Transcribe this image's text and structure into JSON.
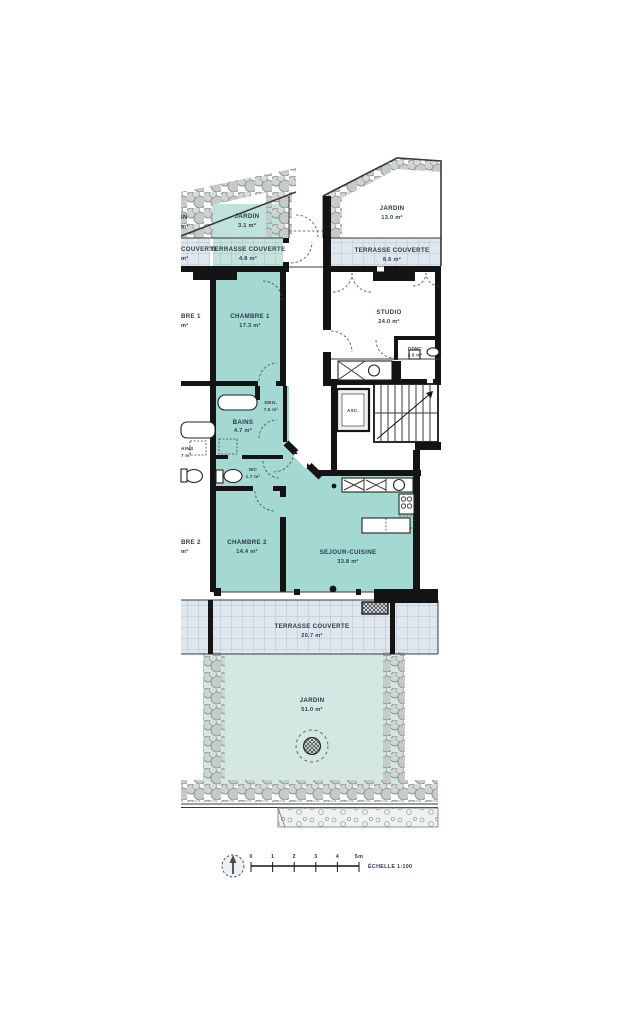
{
  "document": {
    "type": "floor-plan",
    "scale_note": "ÉCHELLE 1:100"
  },
  "colors": {
    "room_teal": "#a3d9d2",
    "jardin_small_teal": "#bfe2db",
    "jardin_large_teal": "#d3e8e3",
    "terrace_blue": "#dfe7ee",
    "terrace_teal": "#c6e2dd",
    "hedge_gray": "#b9bdbc",
    "wall_black": "#141414",
    "label_text": "#2c3b4d"
  },
  "labels": {
    "jardin_small": {
      "name": "JARDIN",
      "area": "3.1 m²"
    },
    "terrasse_48": {
      "name": "TERRASSE COUVERTE",
      "area": "4.8 m²"
    },
    "jardin_13": {
      "name": "JARDIN",
      "area": "13.0 m²"
    },
    "terrasse_86": {
      "name": "TERRASSE COUVERTE",
      "area": "8.6 m²"
    },
    "chambre1": {
      "name": "CHAMBRE 1",
      "area": "17.3 m²"
    },
    "studio": {
      "name": "STUDIO",
      "area": "24.0 m²"
    },
    "dwc": {
      "name": "D/WC",
      "area": "3.5 m²"
    },
    "deg": {
      "name": "DEG.",
      "area": "7.6 m²"
    },
    "bains": {
      "name": "BAINS",
      "area": "4.7 m²"
    },
    "wc": {
      "name": "WC",
      "area": "1.7 m²"
    },
    "chambre2": {
      "name": "CHAMBRE 2",
      "area": "14.4 m²"
    },
    "sejour": {
      "name": "SEJOUR-CUISINE",
      "area": "33.8 m²"
    },
    "terrasse_207": {
      "name": "TERRASSE COUVERTE",
      "area": "20.7 m²"
    },
    "jardin_51": {
      "name": "JARDIN",
      "area": "51.0 m²"
    },
    "asc": {
      "name": "ASC."
    },
    "partial_jardin": {
      "name": "IN",
      "area": "m²"
    },
    "partial_terrasse": {
      "name": "COUVERTE",
      "area": "m²"
    },
    "partial_chambre1": {
      "name": "BRE 1",
      "area": "m²"
    },
    "partial_bains": {
      "name": "AINS",
      "area": "7 m²"
    },
    "partial_chambre2": {
      "name": "BRE 2",
      "area": "m²"
    }
  },
  "scalebar": {
    "ticks": [
      "0",
      "1",
      "2",
      "3",
      "4",
      "5m"
    ],
    "echelle": "ÉCHELLE 1:100"
  }
}
